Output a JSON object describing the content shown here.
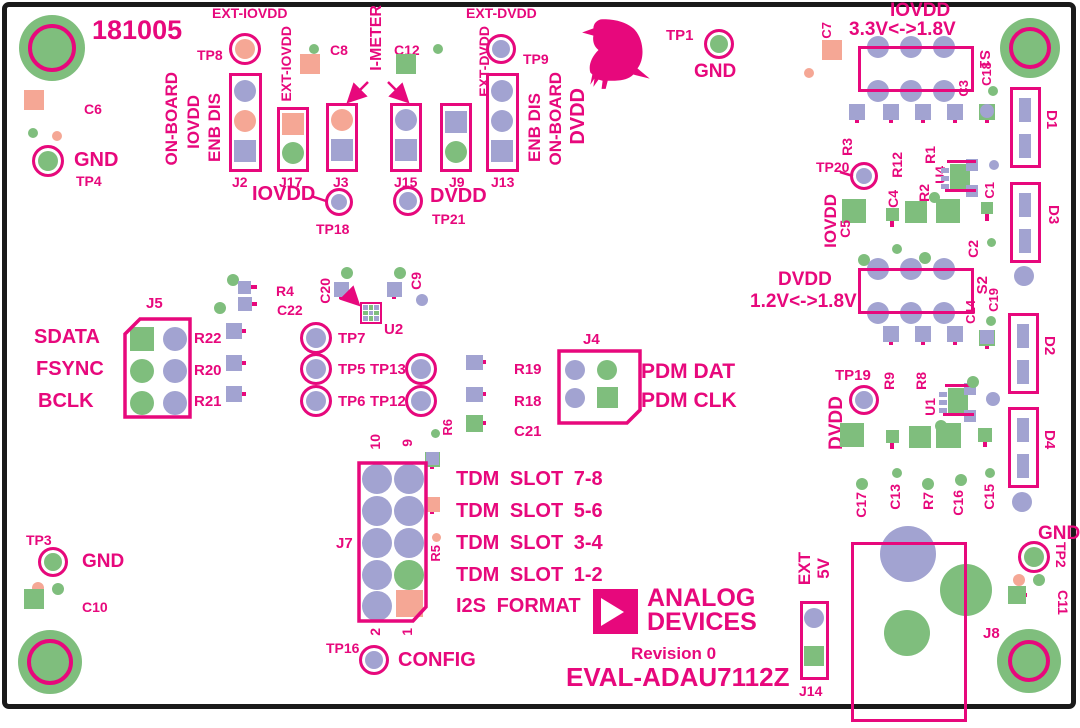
{
  "colors": {
    "silkscreen": "#E7087C",
    "pad_purple": "#A2A3D1",
    "pad_green": "#7FBE7D",
    "pad_salmon": "#F5A795",
    "board_edge": "#1A1A1A"
  },
  "board": {
    "serial": "181005",
    "brand_line1": "ANALOG",
    "brand_line2": "DEVICES",
    "revision": "Revision 0",
    "part_number": "EVAL-ADAU7112Z"
  },
  "icons": {
    "bird": "pigeon-silhouette",
    "logo": "analog-devices-triangle-logo"
  },
  "labels": {
    "c6": "C6",
    "gnd_tp4": "GND",
    "tp4": "TP4",
    "ext_iovdd_top": "EXT-IOVDD",
    "tp8": "TP8",
    "on_board_l": "ON-BOARD",
    "iovdd_l": "IOVDD",
    "enb_dis_l": "ENB DIS",
    "j2": "J2",
    "ext_iovdd_side": "EXT-IOVDD",
    "j17": "J17",
    "c8": "C8",
    "j3": "J3",
    "i_meter": "I-METER",
    "c12": "C12",
    "j15": "J15",
    "j9": "J9",
    "ext_dvdd_side": "EXT-DVDD",
    "ext_dvdd_top": "EXT-DVDD",
    "tp9": "TP9",
    "j13": "J13",
    "enb_dis_r": "ENB DIS",
    "on_board_r": "ON-BOARD",
    "dvdd_r": "DVDD",
    "iovdd_tp18": "IOVDD",
    "tp18": "TP18",
    "dvdd_tp21": "DVDD",
    "tp21": "TP21",
    "tp1": "TP1",
    "gnd_tp1": "GND",
    "c7": "C7",
    "iovdd_rail": "IOVDD",
    "iovdd_range": "3.3V<->1.8V",
    "s1": "S1",
    "c3": "C3",
    "c18": "C18",
    "d1": "D1",
    "r3": "R3",
    "tp20": "TP20",
    "r12": "R12",
    "r1": "R1",
    "u4": "U4",
    "r2": "R2",
    "c4": "C4",
    "c5": "C5",
    "c2": "C2",
    "c1": "C1",
    "d3": "D3",
    "iovdd_tp20": "IOVDD",
    "dvdd_rail": "DVDD",
    "dvdd_range": "1.2V<->1.8V",
    "s2": "S2",
    "c14": "C14",
    "c19": "C19",
    "r9": "R9",
    "r8": "R8",
    "u1": "U1",
    "tp19": "TP19",
    "dvdd_tp19": "DVDD",
    "c17": "C17",
    "c13": "C13",
    "r7": "R7",
    "c16": "C16",
    "c15": "C15",
    "d2": "D2",
    "d4": "D4",
    "j5": "J5",
    "sdata": "SDATA",
    "fsync": "FSYNC",
    "bclk": "BCLK",
    "r22": "R22",
    "r20": "R20",
    "r21": "R21",
    "r4": "R4",
    "c22": "C22",
    "c20": "C20",
    "c9": "C9",
    "u2": "U2",
    "tp7": "TP7",
    "tp5": "TP5",
    "tp6": "TP6",
    "tp13": "TP13",
    "tp12": "TP12",
    "r19": "R19",
    "r18": "R18",
    "c21": "C21",
    "r6": "R6",
    "r5": "R5",
    "j4": "J4",
    "pdm_dat": "PDM DAT",
    "pdm_clk": "PDM CLK",
    "j7": "J7",
    "pin10": "10",
    "pin9": "9",
    "pin2": "2",
    "pin1": "1",
    "tp16": "TP16",
    "config": "CONFIG",
    "tp3": "TP3",
    "gnd_tp3": "GND",
    "c10": "C10",
    "ext_5v_line1": "EXT",
    "ext_5v_line2": "5V",
    "j14": "J14",
    "j8": "J8",
    "gnd_tp2": "GND",
    "tp2": "TP2",
    "c11": "C11"
  },
  "tdm": [
    "TDM SLOT 7-8",
    "TDM SLOT 5-6",
    "TDM SLOT 3-4",
    "TDM SLOT 1-2",
    "I2S FORMAT"
  ]
}
